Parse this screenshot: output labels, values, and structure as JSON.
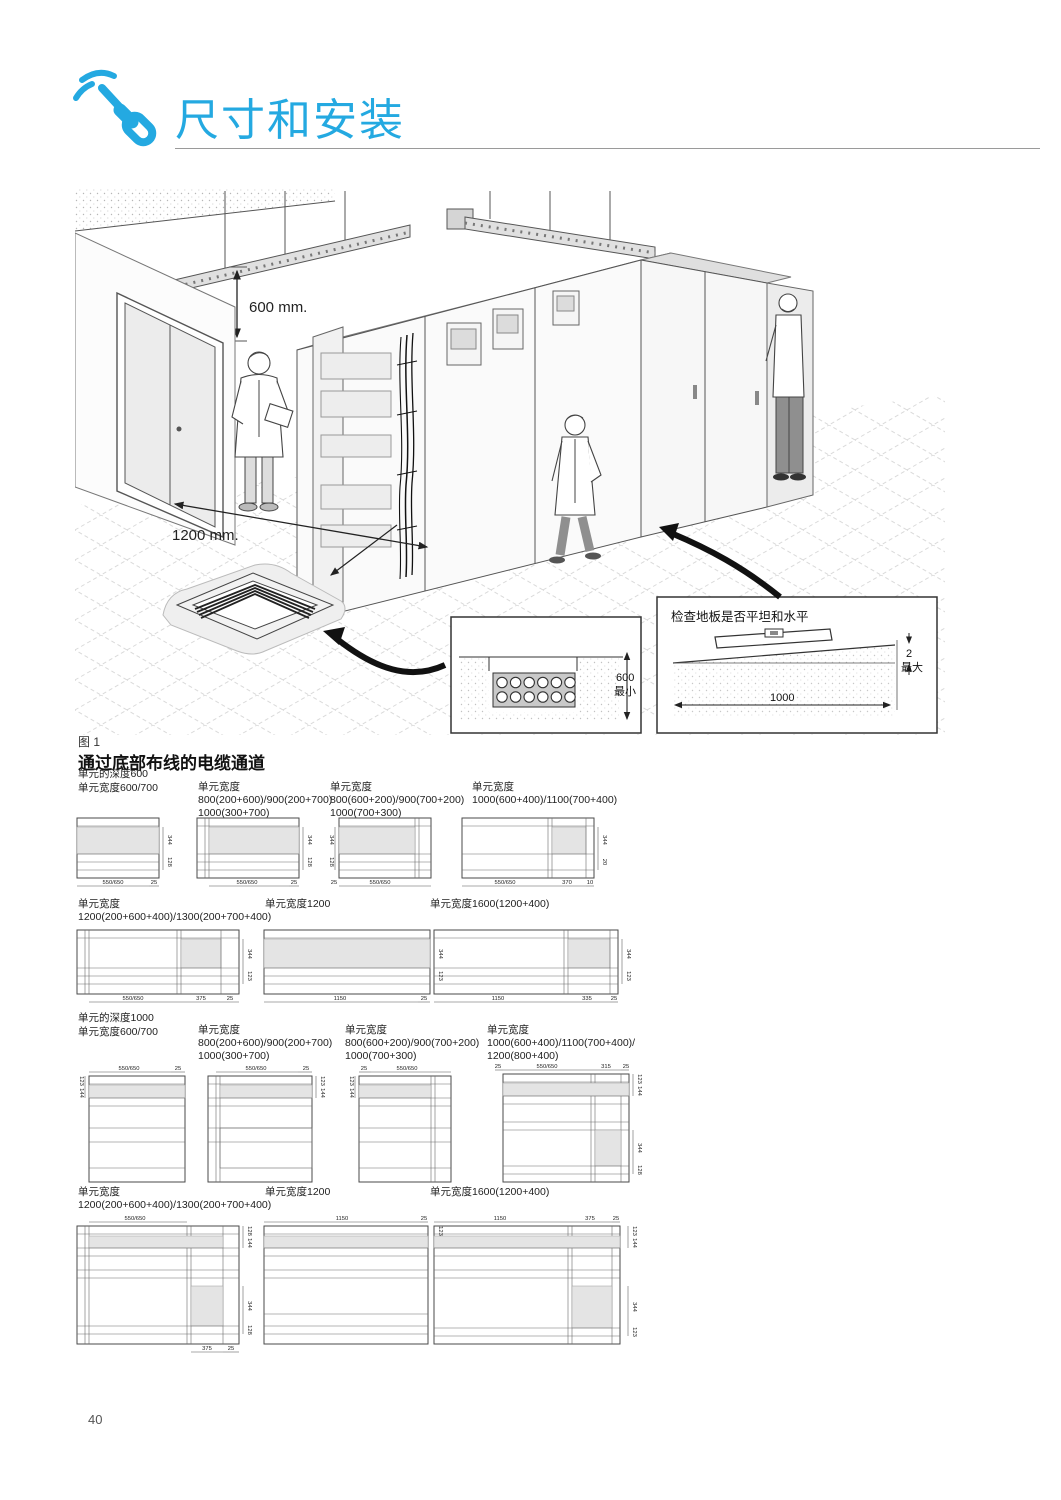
{
  "page": {
    "number": "40"
  },
  "header": {
    "title": "尺寸和安装"
  },
  "illustration": {
    "dim_ceiling": "600 mm.",
    "dim_floor": "1200 mm.",
    "caption": "图 1",
    "trench_callout": {
      "dim": "600",
      "note": "最小"
    },
    "level_callout": {
      "title": "检查地板是否平坦和水平",
      "width": "1000",
      "gap": "2",
      "gap_note": "最大"
    }
  },
  "section": {
    "title": "通过底部布线的电缆通道"
  },
  "groups": [
    {
      "depth_label": "单元的深度600",
      "items": [
        {
          "l1": "单元宽度600/700",
          "l2": "",
          "l3": "",
          "dims": {
            "b1": "550/650",
            "b2": "25",
            "r1": "344",
            "r2": "128"
          }
        },
        {
          "l1": "单元宽度",
          "l2": "800(200+600)/900(200+700)",
          "l3": "1000(300+700)",
          "dims": {
            "b1": "550/650",
            "b2": "25",
            "r1": "344",
            "r2": "128"
          }
        },
        {
          "l1": "单元宽度",
          "l2": "800(600+200)/900(700+200)",
          "l3": "1000(700+300)",
          "dims": {
            "b1": "25",
            "b2": "550/650",
            "r1": "344",
            "r2": "128"
          }
        },
        {
          "l1": "单元宽度",
          "l2": "1000(600+400)/1100(700+400)",
          "l3": "",
          "dims": {
            "b1": "550/650",
            "b2": "370",
            "b3": "10",
            "r1": "344",
            "r2": "20"
          }
        }
      ]
    },
    {
      "depth_label": "",
      "items": [
        {
          "l1": "单元宽度",
          "l2": "1200(200+600+400)/1300(200+700+400)",
          "l3": "",
          "dims": {
            "b1": "550/650",
            "b2": "375",
            "b3": "25",
            "r1": "344",
            "r2": "123"
          }
        },
        {
          "l1": "单元宽度1200",
          "l2": "",
          "l3": "",
          "dims": {
            "b1": "1150",
            "b2": "25",
            "r1": "344",
            "r2": "123"
          }
        },
        {
          "l1": "单元宽度1600(1200+400)",
          "l2": "",
          "l3": "",
          "dims": {
            "b1": "1150",
            "b2": "335",
            "b3": "25",
            "r1": "344",
            "r2": "123"
          }
        }
      ]
    },
    {
      "depth_label": "单元的深度1000",
      "items": [
        {
          "l1": "单元宽度600/700",
          "l2": "",
          "l3": "",
          "dims": {
            "t1": "550/650",
            "t2": "25",
            "s1": "123",
            "s2": "144"
          }
        },
        {
          "l1": "单元宽度",
          "l2": "800(200+600)/900(200+700)",
          "l3": "1000(300+700)",
          "dims": {
            "t1": "550/650",
            "t2": "25",
            "s1": "123",
            "s2": "144"
          }
        },
        {
          "l1": "单元宽度",
          "l2": "800(600+200)/900(700+200)",
          "l3": "1000(700+300)",
          "dims": {
            "t1": "25",
            "t2": "550/650",
            "s1": "123",
            "s2": "144"
          }
        },
        {
          "l1": "单元宽度",
          "l2": "1000(600+400)/1100(700+400)/",
          "l3": "1200(800+400)",
          "dims": {
            "t1": "25",
            "t2": "550/650",
            "t3": "315",
            "t4": "25",
            "s1": "123",
            "s2": "144",
            "s3": "344",
            "s4": "128"
          }
        }
      ]
    },
    {
      "depth_label": "",
      "items": [
        {
          "l1": "单元宽度",
          "l2": "1200(200+600+400)/1300(200+700+400)",
          "l3": "",
          "dims": {
            "t1": "550/650",
            "s1": "128",
            "s2": "144",
            "s3": "344",
            "s4": "128",
            "b1": "375",
            "b2": "25"
          }
        },
        {
          "l1": "单元宽度1200",
          "l2": "",
          "l3": "",
          "dims": {
            "t1": "1150",
            "t2": "25",
            "s1": "123",
            "s2": "144"
          }
        },
        {
          "l1": "单元宽度1600(1200+400)",
          "l2": "",
          "l3": "",
          "dims": {
            "t1": "1150",
            "t2": "375",
            "t3": "25",
            "s1": "123",
            "s2": "144",
            "s3": "344",
            "s4": "123"
          }
        }
      ]
    }
  ]
}
